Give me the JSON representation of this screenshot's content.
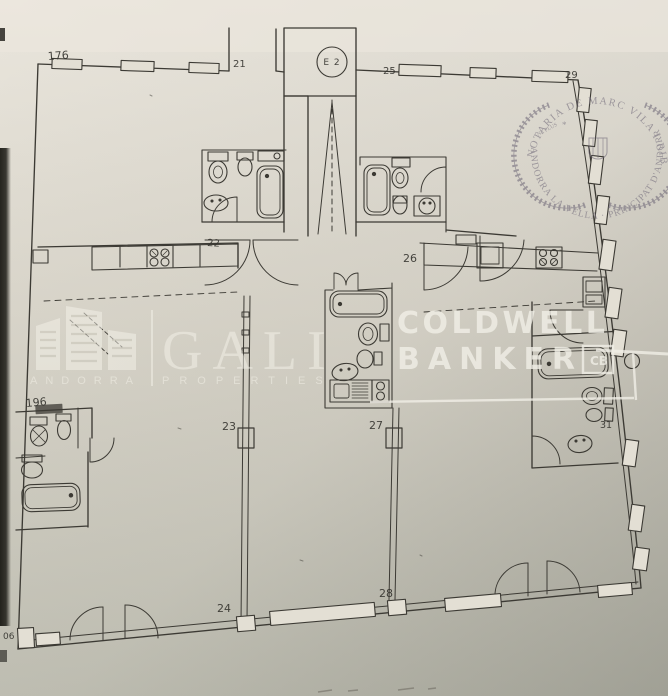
{
  "plan": {
    "elevator_label": "E 2",
    "room_labels": {
      "n176": "176",
      "n21": "21",
      "n25": "25",
      "n29": "29",
      "n22": "22",
      "n26": "26",
      "n196": "196",
      "n23": "23",
      "n27": "27",
      "n31": "31",
      "n24": "24",
      "n28": "28",
      "n06": "06"
    }
  },
  "watermarks": {
    "gali": {
      "name": "GALI",
      "tagline_left": "ANDORRA",
      "tagline_right": "PROPERTIES"
    },
    "coldwell_banker": {
      "line1": "COLDWELL",
      "line2": "BANKER",
      "box_glyph": "CB"
    }
  },
  "stamp": {
    "arc_top": "NOTARIA DE MARC VILA I RIBA",
    "arc_bottom": "ANDORRA LA VELLA · PRINCIPAT D'ANDORRA",
    "motto": "NE PLUS",
    "star": "*"
  },
  "colors": {
    "paper_light": "#eae6dd",
    "paper_mid": "#dcd8cd",
    "paper_dark": "#c6c5b9",
    "ink": "#3c3a34",
    "stamp_ink": "#6f6878",
    "watermark_white": "#f4f2ea"
  }
}
